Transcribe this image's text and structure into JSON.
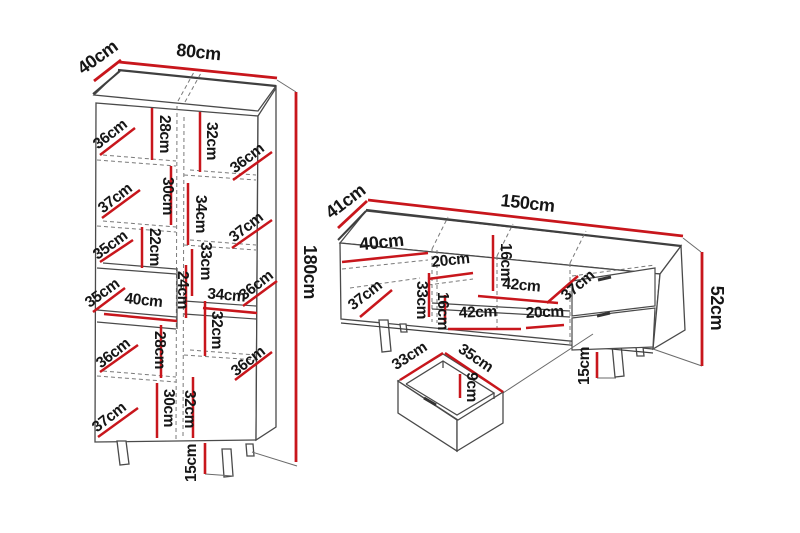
{
  "diagram_type": "furniture-dimension-diagram",
  "unit": "cm",
  "colors": {
    "dimension_line": "#c8161c",
    "outline": "#4a4a4a",
    "hidden_line": "#7a7a7a",
    "label_text": "#161616",
    "background": "#ffffff"
  },
  "cabinet": {
    "overall": {
      "depth": "40cm",
      "width": "80cm",
      "height": "180cm",
      "leg_height": "15cm"
    },
    "cells": [
      "36cm",
      "28cm",
      "32cm",
      "36cm",
      "37cm",
      "30cm",
      "34cm",
      "37cm",
      "35cm",
      "22cm",
      "33cm",
      "35cm",
      "40cm",
      "24cm",
      "34cm",
      "36cm",
      "28cm",
      "32cm",
      "36cm",
      "36cm",
      "30cm",
      "32cm",
      "37cm"
    ]
  },
  "tv_stand": {
    "overall": {
      "depth": "41cm",
      "width": "150cm",
      "height": "52cm",
      "leg_height": "15cm"
    },
    "cells": [
      "40cm",
      "20cm",
      "16cm",
      "42cm",
      "37cm",
      "37cm",
      "33cm",
      "16cm",
      "42cm",
      "20cm"
    ]
  },
  "drawer_detail": {
    "width": "33cm",
    "depth": "35cm",
    "height": "9cm"
  }
}
